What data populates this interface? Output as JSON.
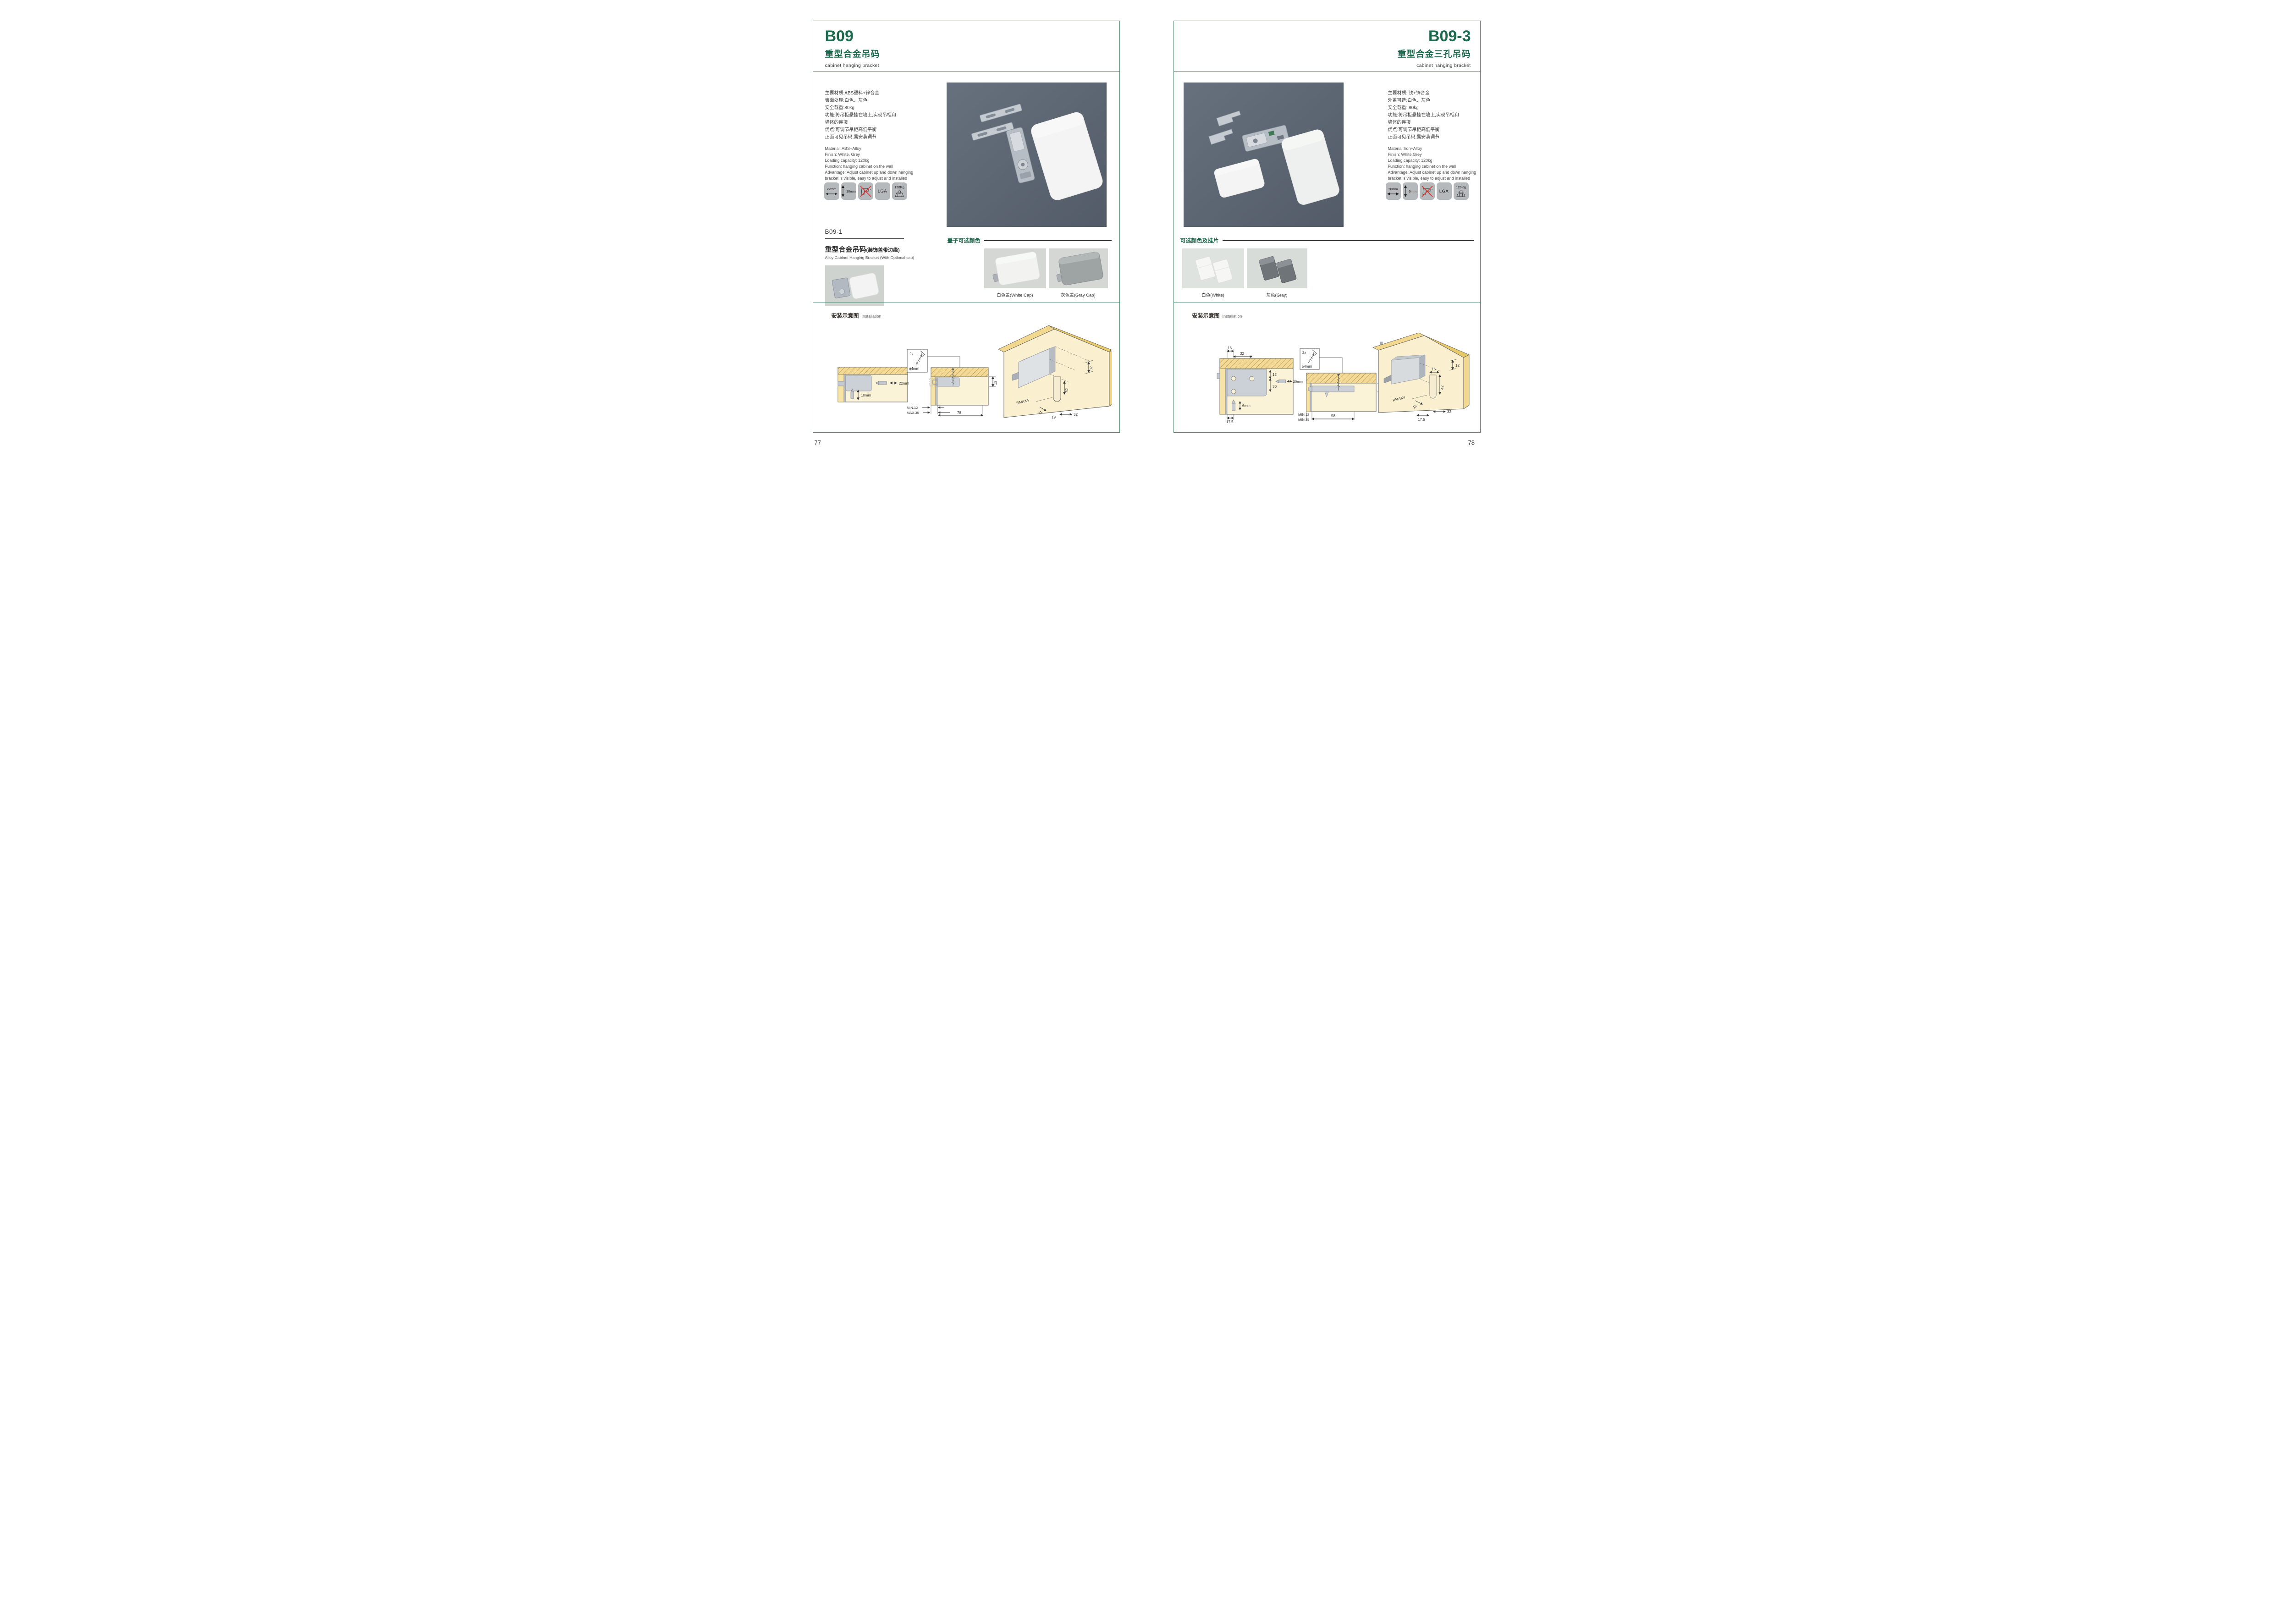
{
  "colors": {
    "accent": "#1d6b4f",
    "panel_border": "#4a8a6e",
    "hero_background": "#5d6672",
    "diagram_wood": "#f3d993",
    "diagram_interior": "#fbf3d8"
  },
  "left_page": {
    "code": "B09",
    "title_cn": "重型合金吊码",
    "title_en": "cabinet hanging bracket",
    "specs_cn": [
      "主要材质:ABS塑料+锌合金",
      "表面处理:白色、灰色",
      "安全载重:80kg",
      "功能:将吊柜悬挂在墙上,实现吊柜和",
      "墙体的连接",
      "优点:可调节吊柜高低平衡",
      "正面可见吊码,易安装调节"
    ],
    "specs_en": [
      "Material: ABS+Alloy",
      "Finish: White, Grey",
      "Loading capacity: 120kg",
      "Function: hanging cabinet on the wall",
      "Advantage: Adjust cabinet up and down hanging",
      "bracket is visible, easy to adjust and installed"
    ],
    "icons": [
      {
        "name": "width-arrow",
        "label": "22mm"
      },
      {
        "name": "depth-arrow",
        "label": "10mm"
      },
      {
        "name": "no-drill",
        "label": ""
      },
      {
        "name": "lga-cert",
        "label": "LGA"
      },
      {
        "name": "load-weight",
        "label": "120Kg"
      }
    ],
    "sub": {
      "code": "B09-1",
      "title_cn": "重型合金吊码",
      "title_note": "(装饰盖带边缘)",
      "title_en": "Alloy Cabinet Hanging Bracket (With Optional cap)"
    },
    "cap_section": {
      "heading": "盖子可选颜色",
      "caption_white": "白色盖(White Cap)",
      "caption_gray": "灰色盖(Gray Cap)"
    },
    "install": {
      "heading_cn": "安装示意图",
      "heading_en": "Installation",
      "d1": {
        "w": "22mm",
        "h": "10mm"
      },
      "d2": {
        "qty": "2x",
        "dia": "ϕ4mm",
        "h": "13",
        "min": "MIN.12",
        "max": "MAX.35",
        "len": "78"
      },
      "d3": {
        "top": "32",
        "inner": "32",
        "r": "RMAX4",
        "a": "11",
        "b": "19",
        "c": "32"
      }
    },
    "page_number": "77"
  },
  "right_page": {
    "code": "B09-3",
    "title_cn": "重型合金三孔吊码",
    "title_en": "cabinet hanging bracket",
    "specs_cn": [
      "主要材质: 铁+锌合金",
      "外盖可选:白色、灰色",
      "安全载重: 80kg",
      "功能:将吊柜悬挂在墙上,实现吊柜和",
      "墙体的连接",
      "优点:可调节吊柜高低平衡",
      "正面可见吊码,易安装调节"
    ],
    "specs_en": [
      "Material:Iron+Alloy",
      "Finish: White,Grey",
      "Loading capacity: 120kg",
      "Function: hanging cabinet on the wall",
      "Advantage: Adjust cabinet up and down hanging",
      "bracket is visible, easy to adjust and installed"
    ],
    "icons": [
      {
        "name": "width-arrow",
        "label": "20mm"
      },
      {
        "name": "depth-arrow",
        "label": "6mm"
      },
      {
        "name": "no-drill",
        "label": ""
      },
      {
        "name": "lga-cert",
        "label": "LGA"
      },
      {
        "name": "load-weight",
        "label": "120Kg"
      }
    ],
    "color_section": {
      "heading": "可选颜色及挂片",
      "caption_white": "白色(White)",
      "caption_gray": "灰色(Gray)"
    },
    "install": {
      "heading_cn": "安装示意图",
      "heading_en": "Installation",
      "d1": {
        "a": "16",
        "b": "32",
        "c": "12",
        "d": "30",
        "e": "20mm",
        "f": "6mm",
        "g": "17.5"
      },
      "d2": {
        "qty": "2x",
        "dia": "ϕ4mm",
        "h": "12",
        "len": "58",
        "min": "MIN.12",
        "min2": "MIN.35"
      },
      "d3": {
        "top": "12",
        "a": "16",
        "b": "42",
        "r": "RMAX4",
        "c": "12",
        "d": "17.5",
        "e": "32"
      }
    },
    "page_number": "78"
  }
}
